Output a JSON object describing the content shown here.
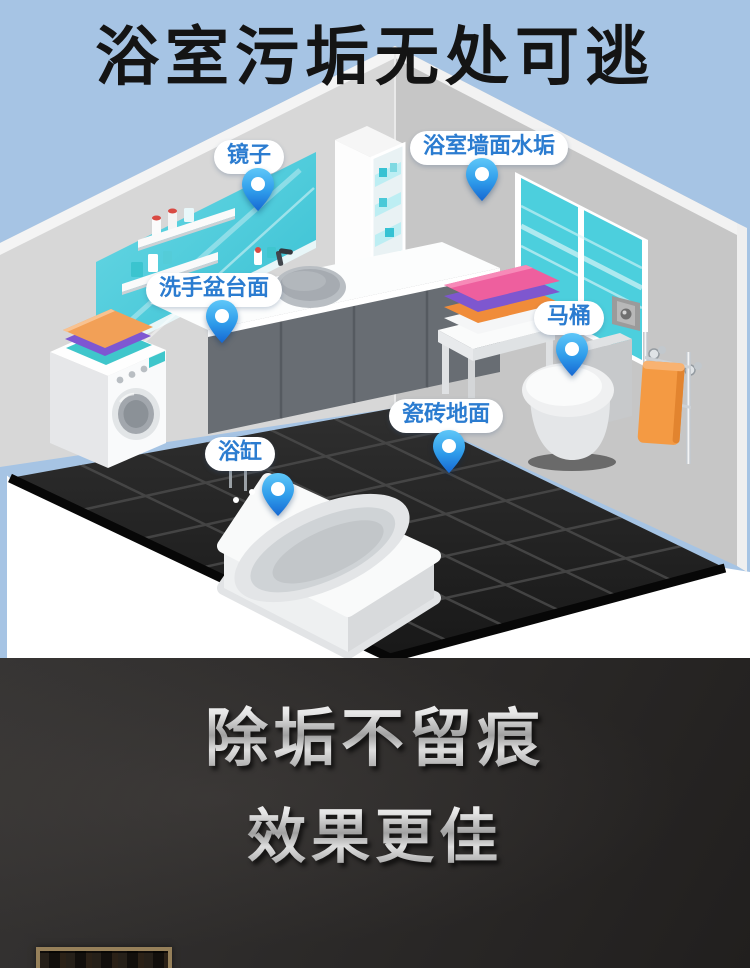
{
  "meta": {
    "width": 750,
    "height": 968
  },
  "hero": {
    "title": "浴室污垢无处可逃",
    "callouts": {
      "mirror": "镜子",
      "wall": "浴室墙面水垢",
      "basin": "洗手盆台面",
      "toilet": "马桶",
      "floor": "瓷砖地面",
      "bathtub": "浴缸"
    },
    "icons": {
      "pin": "location-pin"
    },
    "colors": {
      "sky": "#a6c4e4",
      "title_text": "#141414",
      "callout_text": "#2b7cd0",
      "callout_background": "#ffffff",
      "pin_blue_top": "#5ec7f8",
      "pin_blue_bottom": "#1668d2",
      "floor_tile": "#1f1f1f",
      "mirror_teal": "#45c9d7",
      "window_teal": "#4ccfdd",
      "towel_orange": "#f29a45",
      "towel_purple": "#7e57cf",
      "towel_pink": "#ee5f9e",
      "towel_teal": "#3fc6cb"
    }
  },
  "footer": {
    "line1": "除垢不留痕",
    "line2": "效果更佳",
    "background": "#2b2928",
    "text_color": "#d3d3d3"
  }
}
